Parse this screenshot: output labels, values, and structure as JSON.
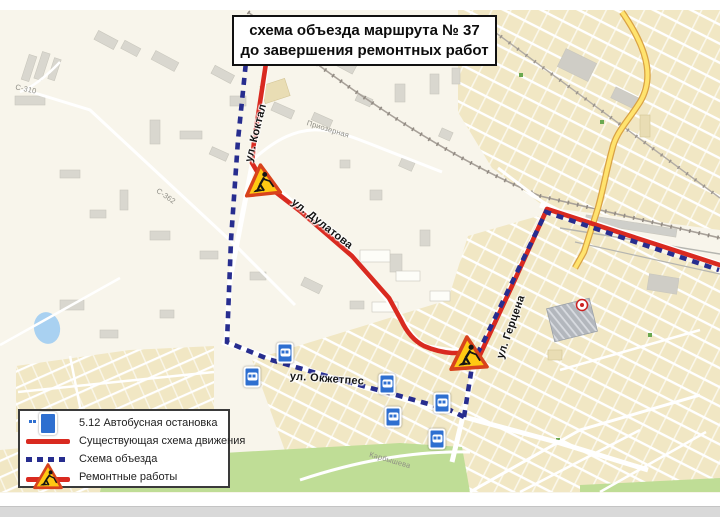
{
  "title": {
    "line1": "схема объезда маршрута № 37",
    "line2": "до завершения ремонтных работ"
  },
  "legend": {
    "bus_stop_label": "5.12 Автобусная остановка",
    "existing_route_label": "Существующая схема движения",
    "detour_label": "Схема объезда",
    "road_works_label": "Ремонтные работы"
  },
  "map": {
    "street_labels": [
      {
        "text": "ул. Коктал",
        "x": 256,
        "y": 133,
        "rot": -76,
        "type": "major"
      },
      {
        "text": "ул. Дулатова",
        "x": 322,
        "y": 224,
        "rot": 38,
        "type": "major"
      },
      {
        "text": "ул. Герцена",
        "x": 511,
        "y": 327,
        "rot": -71,
        "type": "major"
      },
      {
        "text": "ул. Окжетпес",
        "x": 327,
        "y": 379,
        "rot": 4,
        "type": "major"
      },
      {
        "text": "Приозерная",
        "x": 328,
        "y": 129,
        "rot": 17,
        "type": "minor"
      },
      {
        "text": "Карбышева",
        "x": 390,
        "y": 460,
        "rot": 16,
        "type": "minor"
      },
      {
        "text": "С-310",
        "x": 26,
        "y": 89,
        "rot": 12,
        "type": "minor"
      },
      {
        "text": "С-362",
        "x": 166,
        "y": 196,
        "rot": 35,
        "type": "minor"
      }
    ],
    "bus_stops": [
      {
        "x": 285,
        "y": 353
      },
      {
        "x": 252,
        "y": 377
      },
      {
        "x": 387,
        "y": 384
      },
      {
        "x": 442,
        "y": 403
      },
      {
        "x": 393,
        "y": 417
      },
      {
        "x": 437,
        "y": 439
      }
    ],
    "roadworks_signs": [
      {
        "x": 262,
        "y": 180,
        "w": 38,
        "h": 34,
        "rot": -6
      },
      {
        "x": 468,
        "y": 353,
        "w": 40,
        "h": 36,
        "rot": -4
      }
    ],
    "colors": {
      "existing_route": "#d92a20",
      "detour_route": "#272d8f",
      "map_base": "#f8f5eb",
      "residential": "#f1e7c4",
      "green_area": "#bfdd96",
      "water": "#a9d1f1",
      "yellow_road": "#ffe36e",
      "sign_fill": "#ffc913",
      "sign_border": "#d8431c",
      "bus_stop_blue": "#2e6fd0"
    }
  }
}
